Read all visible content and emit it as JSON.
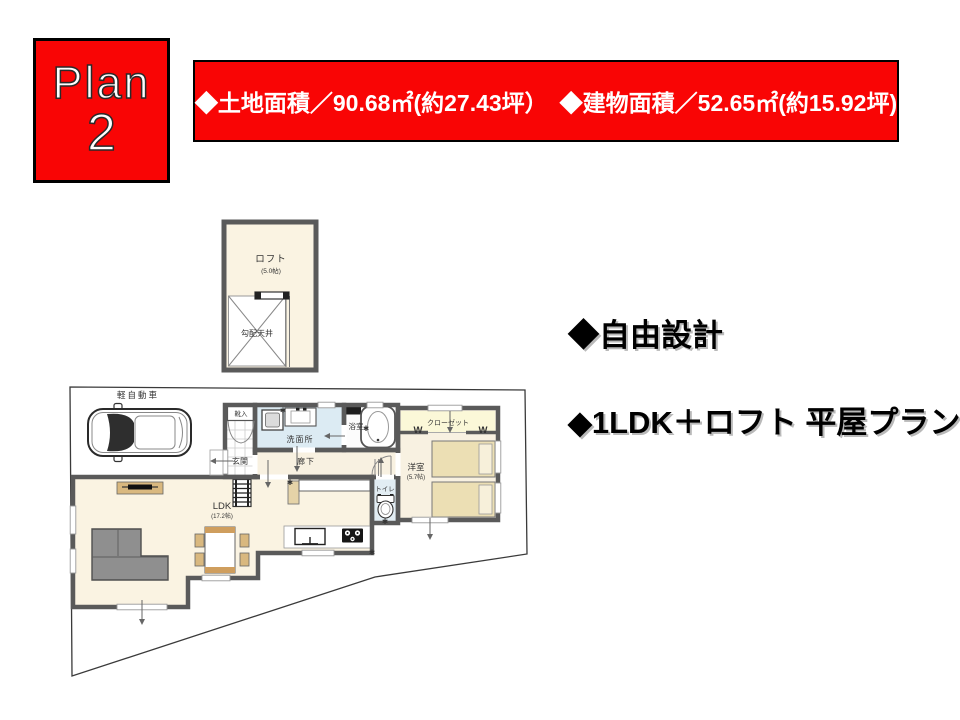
{
  "badge": {
    "line1": "Plan",
    "line2": "2"
  },
  "header": {
    "land_area": "◆土地面積／90.68㎡(約27.43坪）",
    "building_area": "◆建物面積／52.65㎡(約15.92坪)"
  },
  "features": {
    "line1": "◆自由設計",
    "line2": "◆1LDK＋ロフト 平屋プラン"
  },
  "colors": {
    "accent_red": "#f90505",
    "wall_gray": "#5a5a5a"
  },
  "loft": {
    "name": "ロフト",
    "size": "(5.0帖)",
    "sloped_ceiling": "勾配天井"
  },
  "floor": {
    "car_label": "軽自動車",
    "shoe_cabinet": "靴入",
    "entrance": "玄関",
    "washroom": "洗面所",
    "bathroom": "浴室",
    "hallway": "廊下",
    "toilet": "トイレ",
    "closet": "クローゼット",
    "bedroom": "洋室",
    "bedroom_size": "(5.7帖)",
    "ldk": "LDK",
    "ldk_size": "(17.2帖)",
    "hanger_mark": "W",
    "marker_glyph": "✱"
  }
}
